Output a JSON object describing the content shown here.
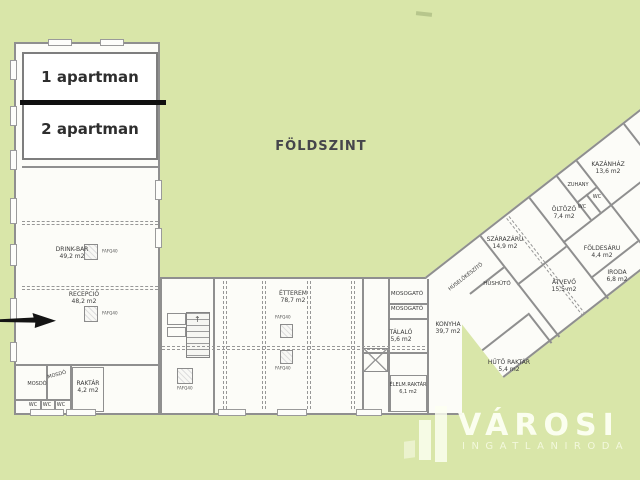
{
  "title": "FÖLDSZINT",
  "apartments": {
    "apartment1": "1 apartman",
    "apartment2": "2 apartman"
  },
  "rooms": {
    "drink_bar": {
      "name": "DRINK-BAR",
      "area": "49,2 m2"
    },
    "recepcio": {
      "name": "RECEPCIÓ",
      "area": "48,2 m2"
    },
    "etterem": {
      "name": "ÉTTEREM",
      "area": "78,7 m2"
    },
    "mosogato_1": {
      "name": "MOSOGATÓ"
    },
    "mosogato_2": {
      "name": "MOSOGATÓ"
    },
    "talalo": {
      "name": "TÁLALÓ",
      "area": "5,6 m2"
    },
    "elelm_raktar": {
      "name": "ÉLELM.RAKTÁR",
      "area": "6,1 m2"
    },
    "konyha": {
      "name": "KONYHA",
      "area": "39,7 m2"
    },
    "hus_elokeszito": {
      "name": "HÚSELŐKÉSZÍTŐ"
    },
    "hushuto": {
      "name": "HÚSHŰTŐ"
    },
    "szarazaru": {
      "name": "SZÁRAZÁRU",
      "area": "14,9 m2"
    },
    "atvevo": {
      "name": "ÁTVEVŐ",
      "area": "15,5 m2"
    },
    "foldesaru": {
      "name": "FÖLDESÁRU",
      "area": "4,4 m2"
    },
    "iroda": {
      "name": "IRODA",
      "area": "6,8 m2"
    },
    "huto_raktar": {
      "name": "HŰTŐ RAKTÁR",
      "area": "5,4 m2"
    },
    "oltozo": {
      "name": "ÖLTÖZŐ",
      "area": "7,4 m2"
    },
    "zuhany": {
      "name": "ZUHANY"
    },
    "wc_diag_1": {
      "name": "WC"
    },
    "wc_diag_2": {
      "name": "WC"
    },
    "kazanhaz": {
      "name": "KAZÁNHÁZ",
      "area": "13,6 m2"
    },
    "mosdo_1": {
      "name": "MOSDÓ"
    },
    "mosdo_2": {
      "name": "MOSDÓ"
    },
    "raktar": {
      "name": "RAKTÁR",
      "area": "4,2 m2"
    },
    "wc_1": {
      "name": "WC"
    },
    "wc_2": {
      "name": "WC"
    },
    "wc_3": {
      "name": "WC"
    }
  },
  "plan": {
    "column_label": "FAFQ40",
    "stair_arrow": "↑"
  },
  "watermark": {
    "brand": "VÁROSI",
    "tagline": "INGATLANIRODA"
  },
  "colors": {
    "background": "#d9e6a9",
    "plan_fill": "#fcfcf8",
    "wall": "#8f8f8f",
    "ink": "#3a3a3a",
    "divider": "#101010",
    "watermark_text": "#fdfff2"
  }
}
